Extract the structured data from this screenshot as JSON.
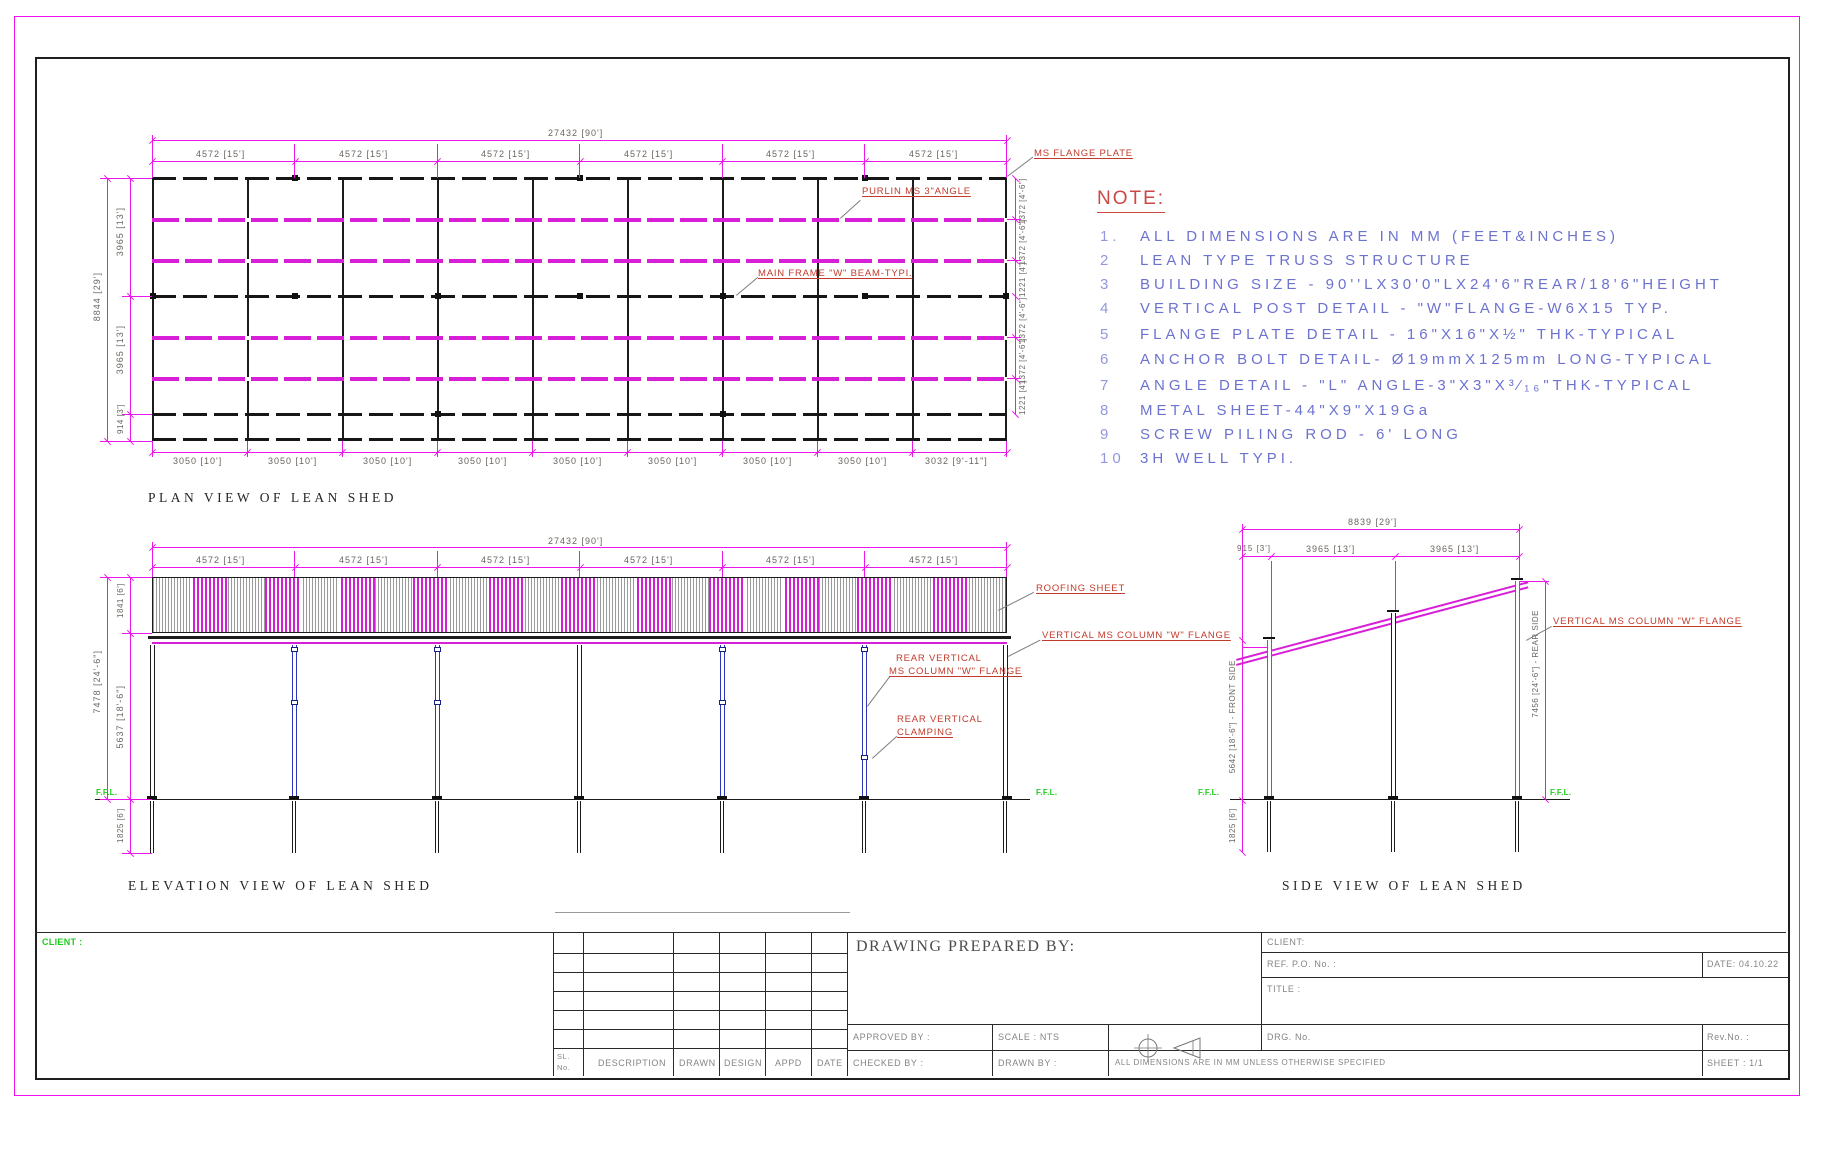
{
  "plan": {
    "title": "PLAN VIEW OF LEAN SHED",
    "overall_width": "27432 [90']",
    "bay": "4572 [15']",
    "bay10": "3050 [10']",
    "bay10_last": "3032 [9'-11\"]",
    "overall_depth": "8844 [29']",
    "row13": "3965 [13']",
    "row3": "914 [3']",
    "sp_a": "1372 [4'-6\"]",
    "sp_b": "1221 [4']",
    "lbl_flange": "MS FLANGE PLATE",
    "lbl_purlin": "PURLIN MS 3\"ANGLE",
    "lbl_frame": "MAIN FRAME \"W\" BEAM-TYPI."
  },
  "ev": {
    "title": "ELEVATION VIEW OF LEAN SHED",
    "overall_width": "27432 [90']",
    "bay": "4572 [15']",
    "roof_d": "1841 [6']",
    "h_total": "7478 [24'-6\"]",
    "h_col": "5637 [18'-6\"]",
    "pile": "1825 [6']",
    "ffl": "F.F.L.",
    "lbl_roof": "ROOFING SHEET",
    "lbl_col": "VERTICAL MS COLUMN \"W\" FLANGE",
    "lbl_rear1": "REAR VERTICAL",
    "lbl_rear2": "MS COLUMN \"W\" FLANGE",
    "lbl_clamp1": "REAR VERTICAL",
    "lbl_clamp2": "CLAMPING"
  },
  "sv": {
    "title": "SIDE VIEW OF LEAN SHED",
    "w": "8839 [29']",
    "a": "915 [3']",
    "b": "3965 [13']",
    "front": "5642 [18'-6\"] - FRONT SIDE",
    "rear": "7456 [24'-6\"] - REAR SIDE",
    "pile": "1825 [6']",
    "ffl": "F.F.L.",
    "lbl_col": "VERTICAL MS COLUMN \"W\" FLANGE"
  },
  "note": {
    "heading": "NOTE:",
    "items": [
      {
        "n": "1.",
        "t": "ALL DIMENSIONS ARE IN MM (FEET&INCHES)"
      },
      {
        "n": "2",
        "t": "LEAN TYPE TRUSS STRUCTURE"
      },
      {
        "n": "3",
        "t": "BUILDING SIZE - 90''LX30'0\"LX24'6\"REAR/18'6\"HEIGHT"
      },
      {
        "n": "4",
        "t": "VERTICAL POST DETAIL - \"W\"FLANGE-W6X15 TYP."
      },
      {
        "n": "5",
        "t": "FLANGE PLATE DETAIL - 16\"X16\"X½\" THK-TYPICAL"
      },
      {
        "n": "6",
        "t": "ANCHOR BOLT DETAIL- Ø19mmX125mm LONG-TYPICAL"
      },
      {
        "n": "7",
        "t": "ANGLE DETAIL - \"L\" ANGLE-3\"X3\"X³⁄₁₆\"THK-TYPICAL"
      },
      {
        "n": "8",
        "t": "METAL SHEET-44\"X9\"X19Ga"
      },
      {
        "n": "9",
        "t": "SCREW PILING ROD - 6' LONG"
      },
      {
        "n": "10",
        "t": "3H WELL TYPI."
      }
    ]
  },
  "tb": {
    "client_left": "CLIENT :",
    "prepared_by": "DRAWING PREPARED BY:",
    "sl": "SL.",
    "no": "No.",
    "description": "DESCRIPTION",
    "drawn": "DRAWN",
    "design": "DESIGN",
    "appd": "APPD",
    "date_col": "DATE",
    "approved_by": "APPROVED BY :",
    "checked_by": "CHECKED BY :",
    "scale": "SCALE : NTS",
    "drawn_by": "DRAWN BY :",
    "dims_note": "ALL DIMENSIONS ARE IN MM UNLESS OTHERWISE SPECIFIED",
    "client": "CLIENT:",
    "ref_po": "REF. P.O. No. :",
    "date": "DATE: 04.10.22",
    "title_label": "TITLE :",
    "drg_no": "DRG. No.",
    "rev_no": "Rev.No. :",
    "sheet": "SHEET : 1/1"
  }
}
